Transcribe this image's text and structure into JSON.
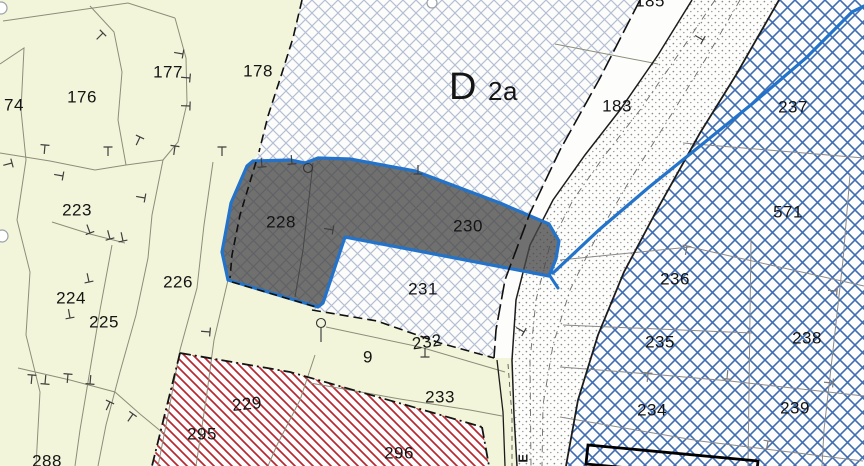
{
  "zone": {
    "main": "D",
    "sub": "2a"
  },
  "parcel_labels": {
    "p74": "74",
    "p176": "176",
    "p177": "177",
    "p178": "178",
    "p185": "185",
    "p183": "183",
    "p223": "223",
    "p224": "224",
    "p225": "225",
    "p226": "226",
    "p228": "228",
    "p230": "230",
    "p231": "231",
    "p232": "232",
    "p9": "9",
    "p233": "233",
    "p229": "229",
    "p295": "295",
    "p296": "296",
    "p288": "288",
    "p237": "237",
    "p571": "571",
    "p236": "236",
    "p235": "235",
    "p238": "238",
    "p234": "234",
    "p239": "239"
  },
  "street_label_fragment": "E",
  "highlight": {
    "selected_parcels": [
      "228",
      "230"
    ],
    "outline_color": "#2273c9",
    "fill_color": "#4a4a4a"
  },
  "colors": {
    "base_area": "#f2f5da",
    "lattice_light": "#b5bfd3",
    "lattice_blue": "#3e6db4",
    "hatch_red": "#b72830",
    "boundary_black": "#141414",
    "parcel_line": "#8d8d79"
  }
}
